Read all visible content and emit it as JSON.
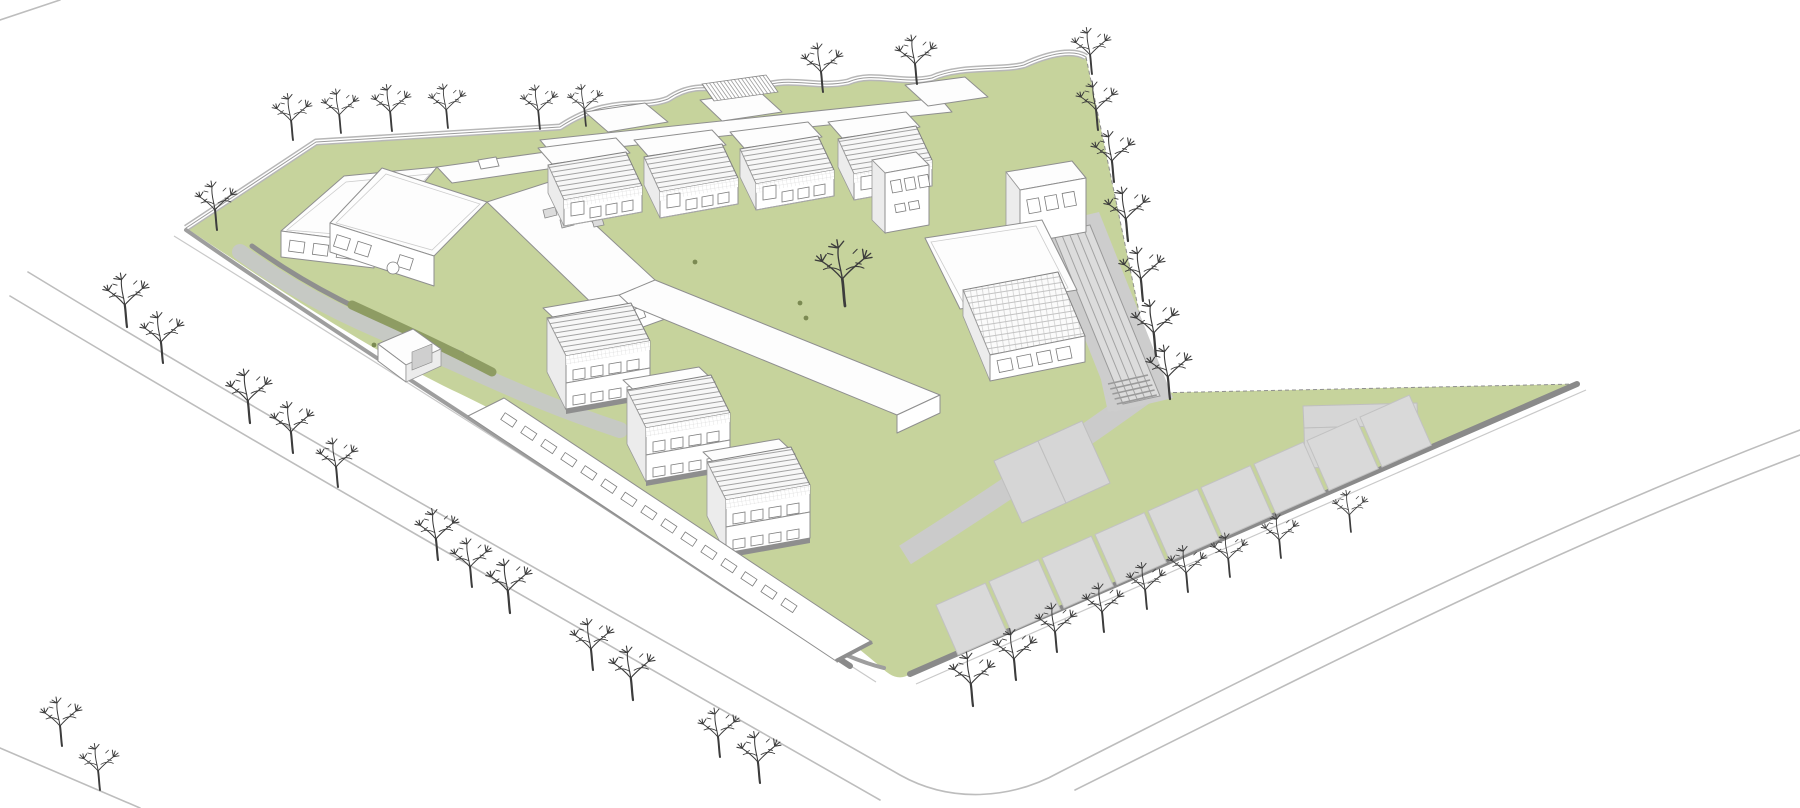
{
  "meta": {
    "description": "Axonometric architectural site rendering of a school campus: white line-drawn buildings, green lawns, gray paths, running track, angled parking stalls and rows of bare winter trees on a white background",
    "style": "monochrome line rendering with green landscape fill",
    "visible_text": []
  },
  "palette": {
    "background": "#ffffff",
    "lawn": "#c6d39c",
    "lawn_dark": "#8e9c63",
    "path": "#cdcdcd",
    "stall": "#d9d9d9",
    "curb": "#8a8a8a",
    "outline": "#8f8f8f",
    "glass_line": "#9a9a9a",
    "tree": "#3c3c3c",
    "building": "#ffffff"
  },
  "scene": {
    "trees": [
      {
        "x": 293,
        "y": 140,
        "s": 0.95
      },
      {
        "x": 341,
        "y": 133,
        "s": 0.9
      },
      {
        "x": 392,
        "y": 131,
        "s": 0.95
      },
      {
        "x": 448,
        "y": 128,
        "s": 0.9
      },
      {
        "x": 540,
        "y": 129,
        "s": 0.9
      },
      {
        "x": 586,
        "y": 126,
        "s": 0.85
      },
      {
        "x": 823,
        "y": 92,
        "s": 1.0
      },
      {
        "x": 917,
        "y": 84,
        "s": 1.0
      },
      {
        "x": 1092,
        "y": 74,
        "s": 0.95
      },
      {
        "x": 1098,
        "y": 130,
        "s": 1.0
      },
      {
        "x": 1114,
        "y": 182,
        "s": 1.05
      },
      {
        "x": 1128,
        "y": 241,
        "s": 1.1
      },
      {
        "x": 1143,
        "y": 301,
        "s": 1.1
      },
      {
        "x": 1156,
        "y": 356,
        "s": 1.15
      },
      {
        "x": 1170,
        "y": 399,
        "s": 1.1
      },
      {
        "x": 973,
        "y": 706,
        "s": 1.1
      },
      {
        "x": 1016,
        "y": 680,
        "s": 1.05
      },
      {
        "x": 1057,
        "y": 652,
        "s": 1.0
      },
      {
        "x": 1104,
        "y": 632,
        "s": 1.0
      },
      {
        "x": 1147,
        "y": 609,
        "s": 0.95
      },
      {
        "x": 1188,
        "y": 592,
        "s": 0.95
      },
      {
        "x": 1230,
        "y": 577,
        "s": 0.9
      },
      {
        "x": 1281,
        "y": 558,
        "s": 0.9
      },
      {
        "x": 1351,
        "y": 532,
        "s": 0.85
      },
      {
        "x": 127,
        "y": 327,
        "s": 1.1
      },
      {
        "x": 163,
        "y": 363,
        "s": 1.05
      },
      {
        "x": 250,
        "y": 423,
        "s": 1.1
      },
      {
        "x": 293,
        "y": 453,
        "s": 1.05
      },
      {
        "x": 338,
        "y": 487,
        "s": 1.0
      },
      {
        "x": 438,
        "y": 560,
        "s": 1.05
      },
      {
        "x": 472,
        "y": 587,
        "s": 1.0
      },
      {
        "x": 510,
        "y": 613,
        "s": 1.1
      },
      {
        "x": 593,
        "y": 670,
        "s": 1.05
      },
      {
        "x": 633,
        "y": 700,
        "s": 1.1
      },
      {
        "x": 720,
        "y": 757,
        "s": 1.0
      },
      {
        "x": 760,
        "y": 783,
        "s": 1.05
      },
      {
        "x": 62,
        "y": 746,
        "s": 1.0
      },
      {
        "x": 100,
        "y": 790,
        "s": 0.95
      },
      {
        "x": 217,
        "y": 230,
        "s": 1.0
      },
      {
        "x": 845,
        "y": 306,
        "s": 1.35
      }
    ],
    "people": [
      {
        "x": 800,
        "y": 303
      },
      {
        "x": 806,
        "y": 318
      },
      {
        "x": 374,
        "y": 345
      },
      {
        "x": 695,
        "y": 262
      }
    ],
    "parking": {
      "start": [
        958,
        655
      ],
      "along": [
        53,
        -23.5
      ],
      "side": [
        -22,
        -50
      ],
      "count": 9,
      "fill_ratio": 0.93
    },
    "courts": {
      "start": [
        1022,
        523
      ],
      "along": [
        44,
        -20
      ],
      "side": [
        -28,
        -62
      ],
      "count": 2
    },
    "track": {
      "corners": [
        [
          1053,
          233
        ],
        [
          1090,
          225
        ],
        [
          1160,
          396
        ],
        [
          1123,
          404
        ]
      ],
      "lanes": 5
    },
    "zebra": {
      "x1": 1108,
      "y1": 384,
      "x2": 1148,
      "y2": 375,
      "count": 5,
      "dx": 2.2,
      "dy": 5
    },
    "ribbon_windows": {
      "origin": [
        504,
        400
      ],
      "angle": 33.5,
      "count": 15,
      "step": 24,
      "w": 14,
      "h": 8,
      "y": 10
    }
  }
}
